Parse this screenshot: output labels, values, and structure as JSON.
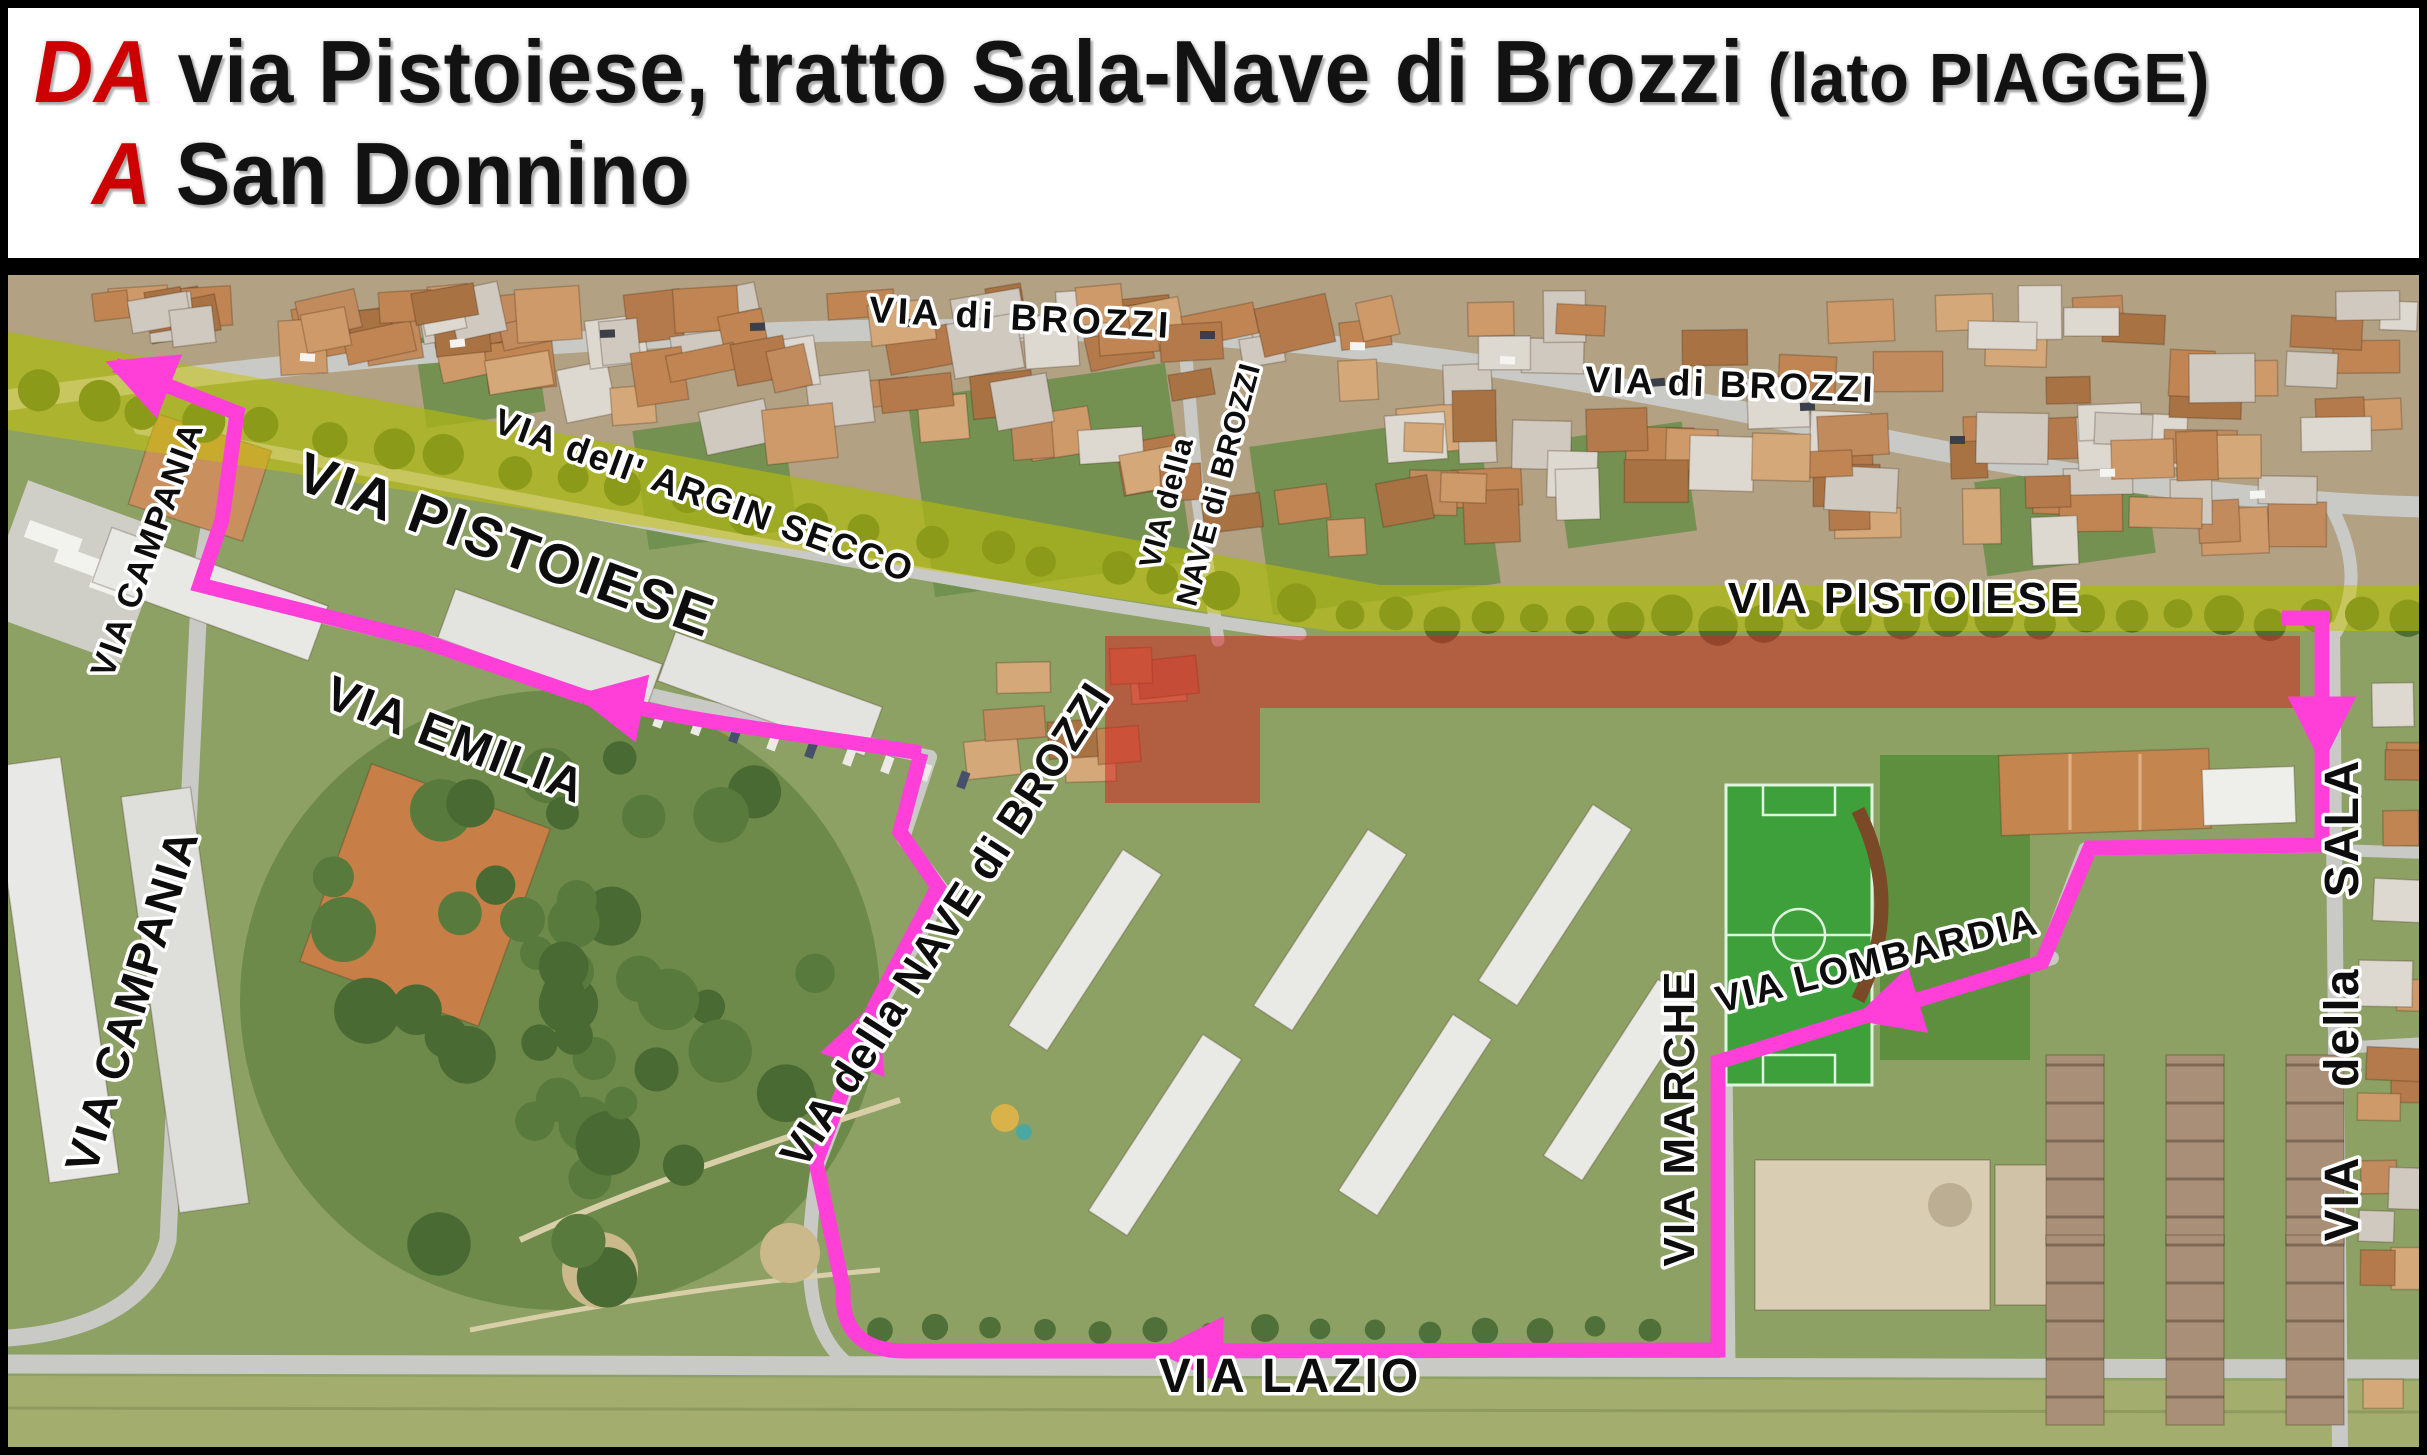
{
  "title": {
    "from_label": "DA",
    "from_text": "via Pistoiese, tratto Sala-Nave di Brozzi",
    "from_suffix": "(lato PIAGGE)",
    "to_label": "A",
    "to_text": "San Donnino",
    "accent_color": "#cc0000",
    "text_color": "#121212",
    "background": "#ffffff"
  },
  "map": {
    "type": "aerial-detour-map",
    "highlighted_road": "VIA PISTOIESE",
    "closed_section_road": "VIA PISTOIESE (tratto Sala-Nave di Brozzi)",
    "colors": {
      "route": "#ff3fd8",
      "road_highlight": "#c8c400",
      "closed_section": "#d42222",
      "road": "#c9c9c5",
      "ground": "#8ca163"
    },
    "pistoiese_highlight_d": "M 8 332 L 1380 585 L 2419 585 L 2419 631 L 1330 631 L 8 430 Z",
    "closed_rects": [
      {
        "x": 1105,
        "y": 636,
        "w": 1195,
        "h": 72
      },
      {
        "x": 1105,
        "y": 708,
        "w": 155,
        "h": 95
      }
    ],
    "roads": [
      {
        "d": "M 8 400 C 400 345 800 320 1150 333 C 1500 347 1750 420 2050 470 C 2200 494 2330 505 2427 507",
        "w": 21
      },
      {
        "d": "M 140 428 C 500 492 900 578 1300 634",
        "w": 13
      },
      {
        "d": "M 1218 640 L 1198 500 L 1186 358",
        "w": 13
      },
      {
        "d": "M 228 418 L 200 580 L 168 1240 C 152 1302 90 1332 8 1338",
        "w": 17
      },
      {
        "d": "M 205 588 C 500 660 760 722 930 757",
        "w": 14
      },
      {
        "d": "M 930 757 L 903 838 L 944 892 L 876 1012 L 818 1165 C 800 1282 812 1332 845 1362",
        "w": 14
      },
      {
        "d": "M 8 1364 L 2419 1369",
        "w": 19
      },
      {
        "d": "M 1725 1062 L 1728 1366",
        "w": 15
      },
      {
        "d": "M 2052 958 L 1727 1068",
        "w": 14
      },
      {
        "d": "M 2332 630 L 2340 1447",
        "w": 16
      },
      {
        "d": "M 2322 846 L 2085 849 L 2042 962",
        "w": 13
      },
      {
        "d": "M 2338 1048 L 2427 1043",
        "w": 12
      },
      {
        "d": "M 2336 850 L 2427 853",
        "w": 12
      },
      {
        "d": "M 2330 505 C 2358 556 2356 596 2336 632",
        "w": 13
      }
    ],
    "route": {
      "width": 15,
      "segments": [
        {
          "d": "M 2282 618 L 2322 618 L 2322 755",
          "arrow": true
        },
        {
          "d": "M 2322 755 L 2322 845 L 2090 848 L 2042 962 L 1862 1017",
          "arrow": true
        },
        {
          "d": "M 1862 1017 L 1718 1062 L 1718 1350 L 1165 1351",
          "arrow": true
        },
        {
          "d": "M 1165 1351 L 905 1351 Q 840 1351 843 1288 L 816 1162 L 873 1010",
          "arrow": true
        },
        {
          "d": "M 873 1010 L 938 887 L 900 832 L 921 753",
          "arrow": false
        },
        {
          "d": "M 921 753 C 820 737 700 722 640 708 L 585 697",
          "arrow": true
        },
        {
          "d": "M 585 697 L 420 640 L 200 585 L 222 520 L 237 413 L 115 365",
          "arrow": true
        }
      ]
    },
    "street_labels": [
      {
        "id": "via-di-brozzi-left",
        "text": "VIA di BROZZI",
        "x": 1020,
        "y": 330,
        "rot": 3,
        "size": 37,
        "ls": 4
      },
      {
        "id": "via-dell-argin-secco",
        "text": "VIA dell' ARGIN SECCO",
        "x": 700,
        "y": 507,
        "rot": 20,
        "size": 36,
        "ls": 2
      },
      {
        "id": "via-pistoiese-diagonal",
        "text": "VIA PISTOIESE",
        "x": 500,
        "y": 563,
        "rot": 20,
        "size": 56,
        "ls": 3
      },
      {
        "id": "via-di-brozzi-right",
        "text": "VIA di BROZZI",
        "x": 1730,
        "y": 397,
        "rot": 2,
        "size": 37,
        "ls": 3
      },
      {
        "id": "via-pistoiese-horizontal",
        "text": "VIA PISTOIESE",
        "x": 1905,
        "y": 613,
        "rot": 0,
        "size": 44,
        "ls": 3
      },
      {
        "id": "via-della-nave-small-1",
        "text": "VIA della",
        "x": 1176,
        "y": 505,
        "rot": -75,
        "size": 30,
        "ls": 1
      },
      {
        "id": "via-della-nave-small-2",
        "text": "NAVE di BROZZI",
        "x": 1228,
        "y": 487,
        "rot": -75,
        "size": 30,
        "ls": 1
      },
      {
        "id": "via-campania-upper",
        "text": "VIA CAMPANIA",
        "x": 158,
        "y": 553,
        "rot": -70,
        "size": 34,
        "ls": 2
      },
      {
        "id": "via-campania-lower",
        "text": "VIA CAMPANIA",
        "x": 147,
        "y": 1005,
        "rot": -73,
        "size": 46,
        "ls": 2
      },
      {
        "id": "via-emilia",
        "text": "VIA EMILIA",
        "x": 450,
        "y": 755,
        "rot": 21,
        "size": 48,
        "ls": 2
      },
      {
        "id": "via-della-nave-big",
        "text": "VIA della NAVE di BROZZI",
        "x": 958,
        "y": 933,
        "rot": -57,
        "size": 44,
        "ls": 1
      },
      {
        "id": "via-lombardia",
        "text": "VIA LOMBARDIA",
        "x": 1880,
        "y": 973,
        "rot": -14,
        "size": 38,
        "ls": 2
      },
      {
        "id": "via-marche",
        "text": "VIA MARCHE",
        "x": 1694,
        "y": 1118,
        "rot": -90,
        "size": 44,
        "ls": 2
      },
      {
        "id": "via-lazio",
        "text": "VIA LAZIO",
        "x": 1290,
        "y": 1392,
        "rot": 0,
        "size": 48,
        "ls": 3
      },
      {
        "id": "via-della-sala",
        "text": "VIA della SALA",
        "x": 2358,
        "y": 1000,
        "rot": -90,
        "size": 48,
        "ls": 2,
        "ws": 55
      }
    ]
  }
}
